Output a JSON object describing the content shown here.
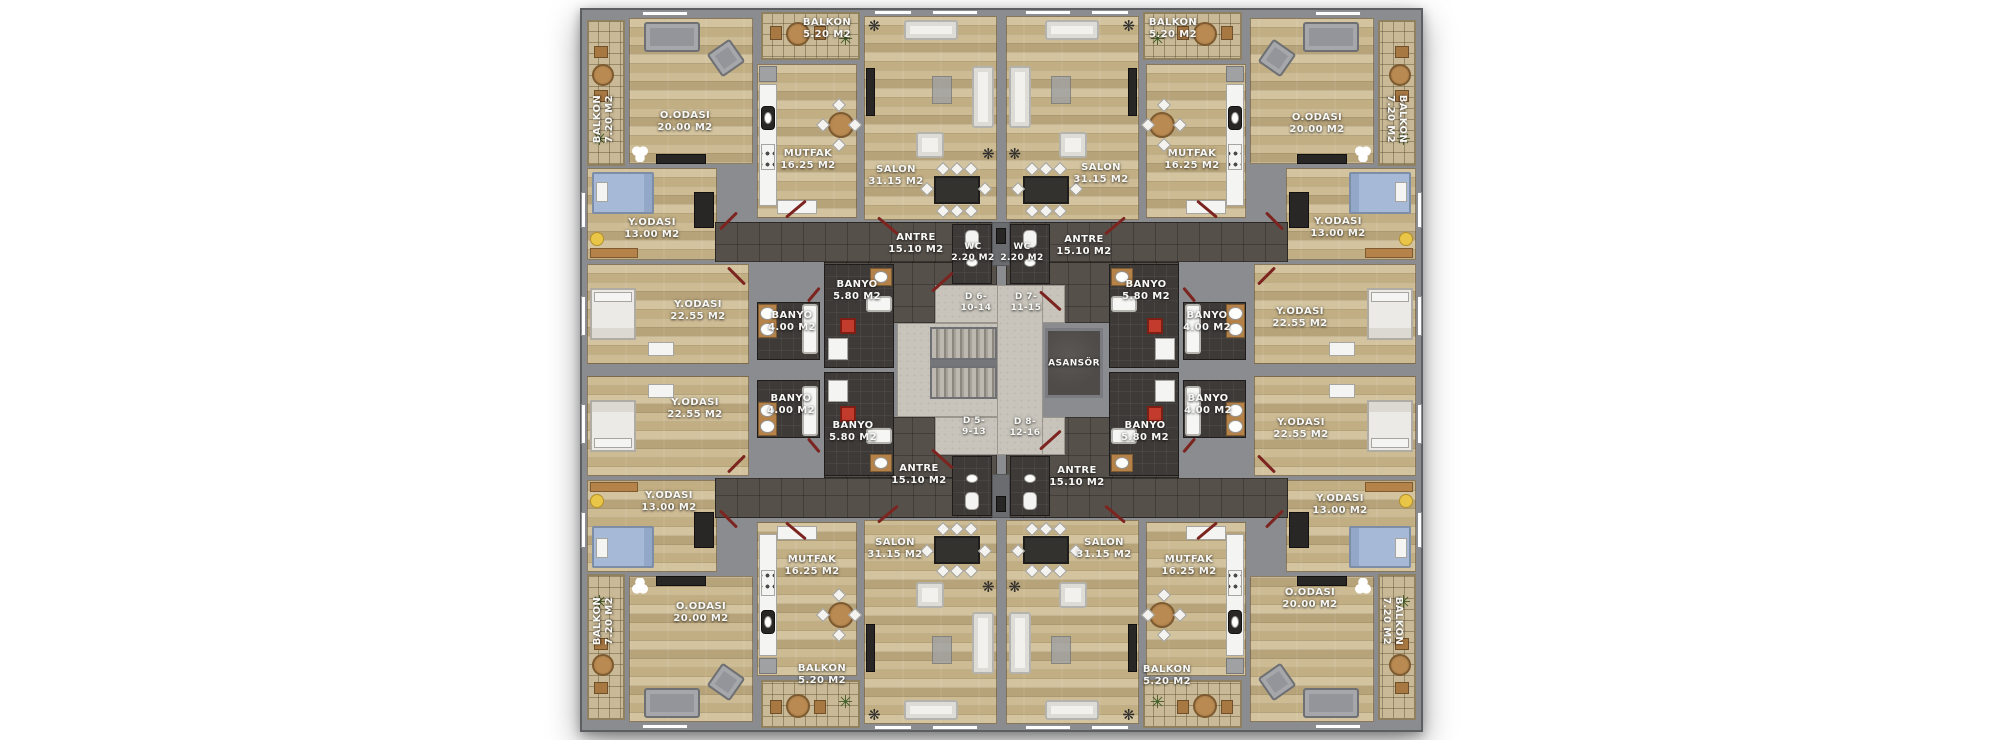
{
  "document": {
    "kind": "apartment-floor-plan",
    "background": "#ffffff"
  },
  "colors": {
    "wall": "#8b8c8f",
    "wood_floor": "#c8b489",
    "balcony_tile": "#c9b996",
    "corridor_floor": "#56504b",
    "bathroom_floor": "#3e3a38",
    "core_floor": "#c8c4bb",
    "elevator": "#4e4b48",
    "accent_red": "#c23b2d",
    "door_swing_red": "#7c241f",
    "label_text": "#f8f8f6"
  },
  "core": {
    "elevator": {
      "label": "ASANSÖR",
      "x": 494,
      "y": 356
    },
    "doors": [
      {
        "id": "d6",
        "lines": [
          "D 6-",
          "10-14"
        ],
        "x": 396,
        "y": 295
      },
      {
        "id": "d7",
        "lines": [
          "D 7-",
          "11-15"
        ],
        "x": 446,
        "y": 295
      },
      {
        "id": "d5",
        "lines": [
          "D 5-",
          "9-13"
        ],
        "x": 394,
        "y": 419
      },
      {
        "id": "d8",
        "lines": [
          "D 8-",
          "12-16"
        ],
        "x": 445,
        "y": 420
      }
    ]
  },
  "apartments": [
    {
      "id": "top-left",
      "rooms": [
        {
          "id": "balkon-side",
          "label": "BALKON",
          "area": "7.20 M2",
          "x": 24,
          "y": 111,
          "rot": -90
        },
        {
          "id": "o-odasi",
          "label": "O.ODASI",
          "area": "20.00 M2",
          "x": 105,
          "y": 114
        },
        {
          "id": "mutfak",
          "label": "MUTFAK",
          "area": "16.25 M2",
          "x": 228,
          "y": 152
        },
        {
          "id": "balkon-top",
          "label": "BALKON",
          "area": "5.20 M2",
          "x": 247,
          "y": 21
        },
        {
          "id": "salon",
          "label": "SALON",
          "area": "31.15 M2",
          "x": 316,
          "y": 168
        },
        {
          "id": "y-odasi-13",
          "label": "Y.ODASI",
          "area": "13.00 M2",
          "x": 72,
          "y": 221
        },
        {
          "id": "y-odasi-22",
          "label": "Y.ODASI",
          "area": "22.55 M2",
          "x": 118,
          "y": 303
        },
        {
          "id": "banyo-58",
          "label": "BANYO",
          "area": "5.80 M2",
          "x": 277,
          "y": 283
        },
        {
          "id": "banyo-40",
          "label": "BANYO",
          "area": "4.00 M2",
          "x": 212,
          "y": 314
        },
        {
          "id": "antre",
          "label": "ANTRE",
          "area": "15.10 M2",
          "x": 336,
          "y": 236
        },
        {
          "id": "wc",
          "label": "WC",
          "area": "2.20 M2",
          "x": 393,
          "y": 245,
          "small": true
        }
      ]
    },
    {
      "id": "top-right",
      "rooms": [
        {
          "id": "balkon-side",
          "label": "BALKON",
          "area": "7.20 M2",
          "x": 816,
          "y": 111,
          "rot": 90
        },
        {
          "id": "o-odasi",
          "label": "O.ODASI",
          "area": "20.00 M2",
          "x": 737,
          "y": 116
        },
        {
          "id": "mutfak",
          "label": "MUTFAK",
          "area": "16.25 M2",
          "x": 612,
          "y": 152
        },
        {
          "id": "balkon-top",
          "label": "BALKON",
          "area": "5.20 M2",
          "x": 593,
          "y": 21
        },
        {
          "id": "salon",
          "label": "SALON",
          "area": "31.15 M2",
          "x": 521,
          "y": 166
        },
        {
          "id": "y-odasi-13",
          "label": "Y.ODASI",
          "area": "13.00 M2",
          "x": 758,
          "y": 220
        },
        {
          "id": "y-odasi-22",
          "label": "Y.ODASI",
          "area": "22.55 M2",
          "x": 720,
          "y": 310
        },
        {
          "id": "banyo-58",
          "label": "BANYO",
          "area": "5.80 M2",
          "x": 566,
          "y": 283
        },
        {
          "id": "banyo-40",
          "label": "BANYO",
          "area": "4.00 M2",
          "x": 627,
          "y": 314
        },
        {
          "id": "antre",
          "label": "ANTRE",
          "area": "15.10 M2",
          "x": 504,
          "y": 238
        },
        {
          "id": "wc",
          "label": "WC",
          "area": "2.20 M2",
          "x": 442,
          "y": 245,
          "small": true
        }
      ]
    },
    {
      "id": "bottom-left",
      "rooms": [
        {
          "id": "balkon-side",
          "label": "BALKON",
          "area": "7.20 M2",
          "x": 24,
          "y": 613,
          "rot": -90
        },
        {
          "id": "o-odasi",
          "label": "O.ODASI",
          "area": "20.00 M2",
          "x": 121,
          "y": 605
        },
        {
          "id": "mutfak",
          "label": "MUTFAK",
          "area": "16.25 M2",
          "x": 232,
          "y": 558
        },
        {
          "id": "balkon-bottom",
          "label": "BALKON",
          "area": "5.20 M2",
          "x": 242,
          "y": 667
        },
        {
          "id": "salon",
          "label": "SALON",
          "area": "31.15 M2",
          "x": 315,
          "y": 541
        },
        {
          "id": "y-odasi-13",
          "label": "Y.ODASI",
          "area": "13.00 M2",
          "x": 89,
          "y": 494
        },
        {
          "id": "y-odasi-22",
          "label": "Y.ODASI",
          "area": "22.55 M2",
          "x": 115,
          "y": 401
        },
        {
          "id": "banyo-58",
          "label": "BANYO",
          "area": "5.80 M2",
          "x": 273,
          "y": 424
        },
        {
          "id": "banyo-40",
          "label": "BANYO",
          "area": "4.00 M2",
          "x": 211,
          "y": 397
        },
        {
          "id": "antre",
          "label": "ANTRE",
          "area": "15.10 M2",
          "x": 339,
          "y": 467
        }
      ]
    },
    {
      "id": "bottom-right",
      "rooms": [
        {
          "id": "balkon-side",
          "label": "BALKON",
          "area": "7.20 M2",
          "x": 812,
          "y": 613,
          "rot": 90
        },
        {
          "id": "o-odasi",
          "label": "O.ODASI",
          "area": "20.00 M2",
          "x": 730,
          "y": 591
        },
        {
          "id": "mutfak",
          "label": "MUTFAK",
          "area": "16.25 M2",
          "x": 609,
          "y": 558
        },
        {
          "id": "balkon-bottom",
          "label": "BALKON",
          "area": "5.20 M2",
          "x": 587,
          "y": 668
        },
        {
          "id": "salon",
          "label": "SALON",
          "area": "31.15 M2",
          "x": 524,
          "y": 541
        },
        {
          "id": "y-odasi-13",
          "label": "Y.ODASI",
          "area": "13.00 M2",
          "x": 760,
          "y": 497
        },
        {
          "id": "y-odasi-22",
          "label": "Y.ODASI",
          "area": "22.55 M2",
          "x": 721,
          "y": 421
        },
        {
          "id": "banyo-58",
          "label": "BANYO",
          "area": "5.80 M2",
          "x": 565,
          "y": 424
        },
        {
          "id": "banyo-40",
          "label": "BANYO",
          "area": "4.00 M2",
          "x": 628,
          "y": 397
        },
        {
          "id": "antre",
          "label": "ANTRE",
          "area": "15.10 M2",
          "x": 497,
          "y": 469
        }
      ]
    }
  ]
}
